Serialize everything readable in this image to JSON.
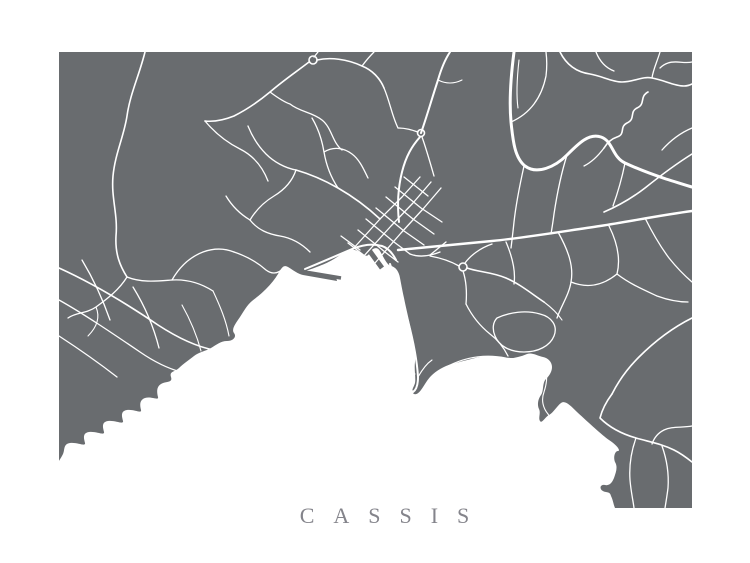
{
  "poster": {
    "title": "CASSIS",
    "title_color": "#84848b",
    "background_color": "#ffffff"
  },
  "map": {
    "land_color": "#696c6f",
    "sea_color": "#ffffff",
    "road_color": "#ffffff"
  }
}
